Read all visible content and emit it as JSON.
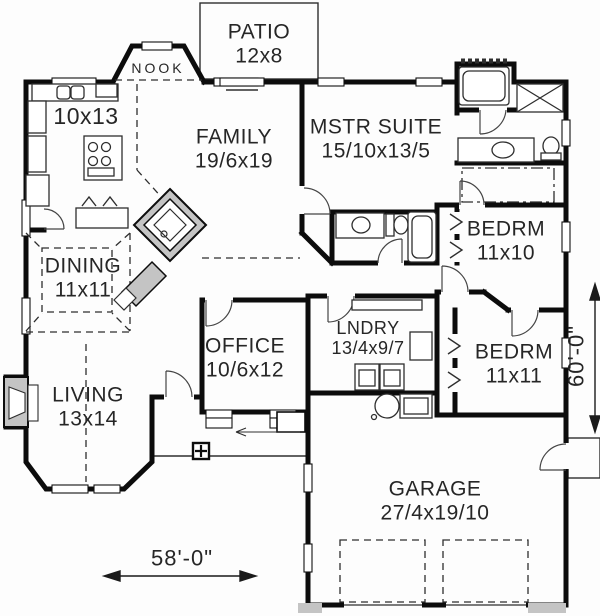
{
  "rooms": {
    "patio": {
      "name": "PATIO",
      "dims": "12x8"
    },
    "nook": {
      "name": "NOOK"
    },
    "kitchen": {
      "dims": "10x13"
    },
    "family": {
      "name": "FAMILY",
      "dims": "19/6x19"
    },
    "mstr": {
      "name": "MSTR SUITE",
      "dims": "15/10x13/5"
    },
    "bedrm1": {
      "name": "BEDRM",
      "dims": "11x10"
    },
    "dining": {
      "name": "DINING",
      "dims": "11x11"
    },
    "office": {
      "name": "OFFICE",
      "dims": "10/6x12"
    },
    "lndry": {
      "name": "LNDRY",
      "dims": "13/4x9/7"
    },
    "bedrm2": {
      "name": "BEDRM",
      "dims": "11x11"
    },
    "living": {
      "name": "LIVING",
      "dims": "13x14"
    },
    "garage": {
      "name": "GARAGE",
      "dims": "27/4x19/10"
    }
  },
  "dimensions": {
    "width": "58'-0\"",
    "height": "60'-0\""
  },
  "fixtures": [
    "kitchen-sink",
    "range",
    "refrigerator",
    "dishwasher",
    "corner-fireplace",
    "living-fireplace",
    "bathtub",
    "shower",
    "toilet",
    "vanity-sink",
    "washer",
    "dryer",
    "utility-sink",
    "water-heater",
    "porch-column",
    "closet-bifold",
    "garage-door",
    "entry-door"
  ],
  "colors": {
    "wall": "#0c0c0c",
    "text": "#262626",
    "background": "#fdfdfd",
    "hatch": "#c4c4c4"
  }
}
